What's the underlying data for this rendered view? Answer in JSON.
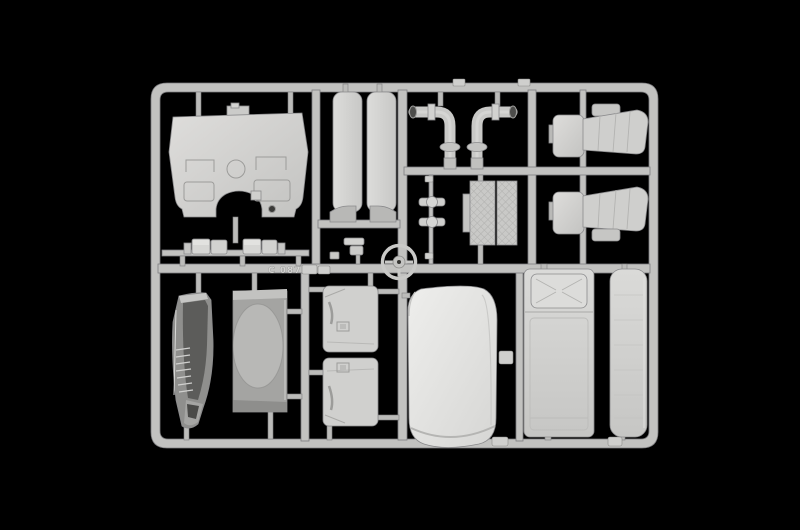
{
  "sprue": {
    "embossed_code": "C 087",
    "plastic_color": "#c9c9c7",
    "plastic_color_light": "#e9e9e7",
    "plastic_color_dark": "#6b6b69",
    "background_color": "#000000",
    "parts": [
      "cab-rear-bulkhead-panel",
      "side-sill-slat-left",
      "side-sill-slat-right",
      "wheel-arch-insert-left",
      "wheel-arch-insert-right",
      "exhaust-pipe-left",
      "exhaust-pipe-right",
      "seat-upper",
      "seat-lower",
      "steering-column-shafts",
      "textured-floor-mat",
      "steering-wheel",
      "small-box-fittings",
      "cab-corner-grille-panel",
      "cab-rear-wall-with-oval-recess",
      "door-card-upper",
      "door-card-lower",
      "roof-panel-white",
      "bunk-bed-with-pillow",
      "bunk-mattress-narrow"
    ]
  }
}
